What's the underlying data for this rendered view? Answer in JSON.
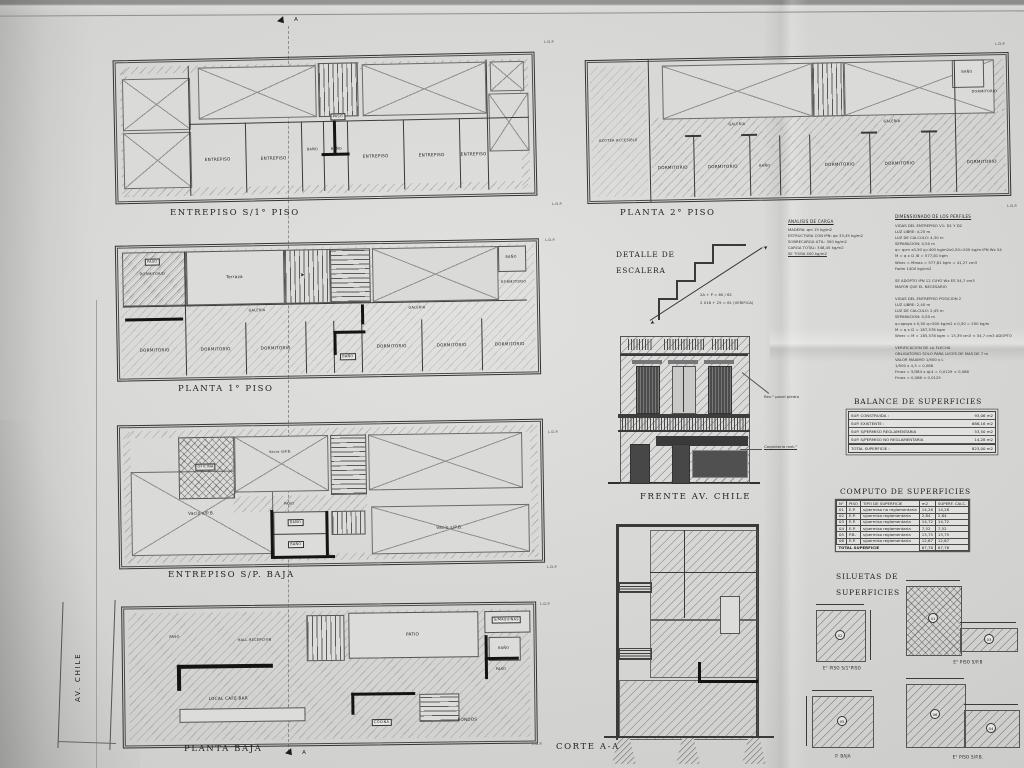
{
  "labels": {
    "entrepiso": "ENTREPISO",
    "bano": "BAÑO",
    "paso": "PASO",
    "dormitorio": "DORMITORIO",
    "galeria": "GALERIA",
    "azotea": "AZOTEA ACCESIBLE",
    "terraza": "Terraza",
    "vacio": "Vacio s/P.B.",
    "oficina": "OFICINA",
    "hall": "HALL RECEPCION",
    "patio": "PATIO",
    "smaquinas": "S/MAQUINAS",
    "local": "LOCAL CAFE BAR",
    "cocina": "COCINA",
    "fondos": "FONDOS"
  },
  "plans": {
    "p1": {
      "title": "ENTREPISO S/1° PISO"
    },
    "p2": {
      "title": "PLANTA 2° PISO"
    },
    "p3": {
      "title": "PLANTA 1° PISO"
    },
    "p4": {
      "title": "ENTREPISO S/P. BAJA"
    },
    "p5": {
      "title": "PLANTA BAJA",
      "street": "AV. CHILE"
    }
  },
  "stair_detail": {
    "title1": "DETALLE DE",
    "title2": "ESCALERA",
    "formula1": "2A + P = 60 / 62",
    "formula2": "2 X18 + 25 = 61 (VERIFICA)"
  },
  "analisis": {
    "title": "ANALISIS DE CARGA",
    "lines": [
      "MADERA:  qm 15 kg/m2",
      "ESTRUCTURA CON IPN:  qe 33,45 kg/m2",
      "SOBRECARGA UTIL:  300 kg/m2",
      "CARGA TOTAL:  348,45 kg/m2",
      "SE TOMA 400 kg/m2"
    ]
  },
  "dimensionado": {
    "title": "DIMENSIONADO DE LOS PERFILES",
    "lines": [
      "VIGAS DEL ENTREPISO V1: D1 Y D2",
      "LUZ LIBRE: 4,25 m",
      "LUZ DE CALCULO: 4,30 m",
      "SEPARACION: 0,50 m",
      "q= qcm x0,50    q=400 kg/m2x0,50=200 kg/m      IPN Wx 54",
      "M = q x l2 /8  =  577,81 kgm",
      "Wnec =  Mmax  =  577,81 kgm  =  41,27 cm3",
      "Fadm    1400 kg/cm2",
      "",
      "SE ADOPTO IPN 12 CUYO Wx ES 54,7 cm3",
      "MAYOR QUE EL NECESARIO",
      "",
      "VIGAS DEL ENTREPISO POSICION 2",
      "LUZ LIBRE: 2,40 m",
      "LUZ DE CALCULO: 2,45 m",
      "SEPARACION: 0,50 m",
      "q=apoyo x 0,50    q=500 kg/m2 x 0,50 = 250 kg/m",
      "M = q x l2  =  187,578 kgm",
      "Wnec = M = 185,578 kgm = 13,39 cm3 < 54,7 cm3 ADOPTO",
      "",
      "VERIFICACION DE LA FLECHA",
      "OBLIGATORIO SOLO PARA LUCES DE MAS DE 7 m",
      "VALOR MAXIMO 1/500 x L",
      "1/500 x 4,3 = 0,086",
      "Fmax = 5/384 x qL4 = 0,0129 < 0,086",
      "Fmax = 0,086 < 0,0125"
    ]
  },
  "frente": {
    "title": "FRENTE AV. CHILE",
    "note_stone": "Rev.° panel piedra",
    "note_metal": "Carpinteria met.°"
  },
  "corte": {
    "title": "CORTE A-A"
  },
  "balance": {
    "title": "BALANCE DE SUPERFICIES",
    "rows": [
      {
        "label": "SUP. CONSTRUIDA :",
        "value": "93,06 m2"
      },
      {
        "label": "SUP. EXISTENTE :",
        "value": "686,16 m2"
      },
      {
        "label": "SUP. S/PERMISO REGLAMENTARIA",
        "value": "53,50 m2"
      },
      {
        "label": "SUP. S/PERMISO NO REGLAMENTARIA",
        "value": "14,28 m2"
      }
    ],
    "total_label": "TOTAL SUPERFICIE :",
    "total_value": "823,00 m2"
  },
  "computo": {
    "title": "COMPUTO DE SUPERFICIES",
    "headers": [
      "N°",
      "PISO",
      "TIPO DE SUPERFICIE",
      "m2",
      "SUPERF. CALC."
    ],
    "rows": [
      [
        "01",
        "E.P.",
        "s/permiso no reglamentaria",
        "14,28",
        "14,28"
      ],
      [
        "02",
        "E.P.",
        "s/permiso reglamentaria",
        "2,84",
        "2,84"
      ],
      [
        "03",
        "E.P.",
        "s/permiso reglamentaria",
        "14,72",
        "14,72"
      ],
      [
        "04",
        "E.P.",
        "s/permiso reglamentaria",
        "7,52",
        "7,52"
      ],
      [
        "05",
        "P.B.",
        "s/permiso reglamentaria",
        "13,75",
        "13,75"
      ],
      [
        "06",
        "E.P.",
        "s/permiso reglamentaria",
        "12,67",
        "12,67"
      ]
    ],
    "total_label": "TOTAL SUPERFICIE",
    "total_m2": "67,78",
    "total_calc": "67,78"
  },
  "siluetas": {
    "title1": "SILUETAS DE",
    "title2": "SUPERFICIES",
    "items": [
      {
        "label": "E° PISO S/1°PISO",
        "num": "02"
      },
      {
        "label": "E° PISO S/P.B",
        "num": "01",
        "num2": "03"
      },
      {
        "label": "P. BAJA",
        "num": "05"
      },
      {
        "label": "E° PISO S/P.B.",
        "num": "06",
        "num2": "04"
      }
    ]
  },
  "markers": {
    "section": "A",
    "ldp": "L.D.P."
  },
  "icons": {
    "stair_arrow": "➤"
  }
}
